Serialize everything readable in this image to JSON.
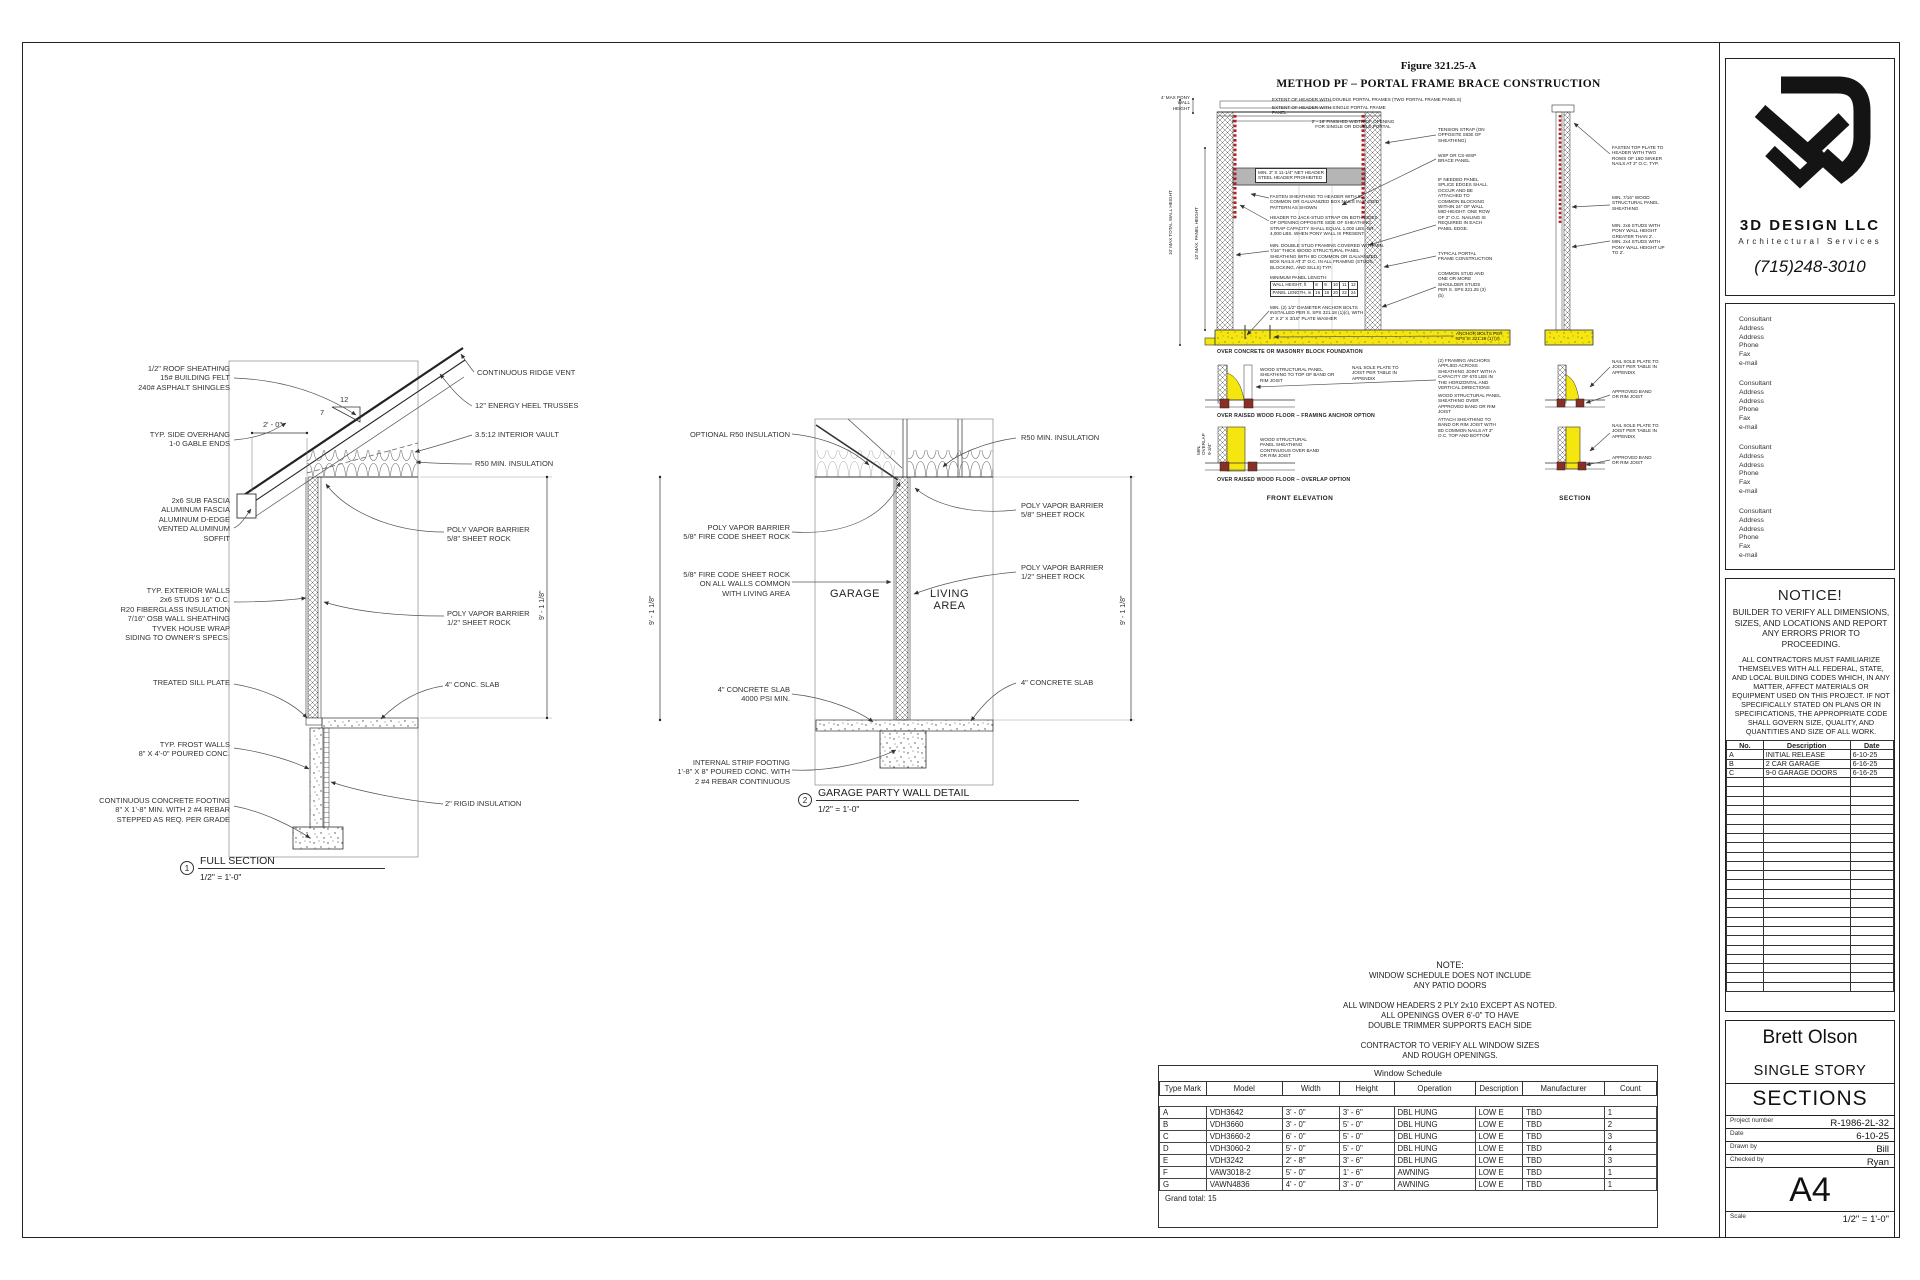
{
  "sheet": {
    "full_section": {
      "left_callouts": [
        "1/2\" ROOF SHEATHING\n15# BUILDING FELT\n240# ASPHALT SHINGLES",
        "TYP. SIDE OVERHANG\n1-0 GABLE ENDS",
        "2x6 SUB FASCIA\nALUMINUM FASCIA\nALUMINUM D-EDGE\nVENTED ALUMINUM\nSOFFIT",
        "TYP. EXTERIOR WALLS\n2x6 STUDS 16\" O.C.\nR20 FIBERGLASS INSULATION\n7/16\" OSB WALL SHEATHING\nTYVEK HOUSE WRAP\nSIDING TO OWNER'S SPECS.",
        "TREATED SILL PLATE",
        "TYP. FROST  WALLS\n8\" X 4'-0\" POURED CONC.",
        "CONTINUOUS CONCRETE FOOTING\n8\" X 1'-8\" MIN. WITH 2 #4 REBAR\nSTEPPED AS REQ. PER GRADE"
      ],
      "right_callouts": [
        "CONTINUOUS RIDGE VENT",
        "12\" ENERGY HEEL TRUSSES",
        "3.5:12 INTERIOR VAULT",
        "R50 MIN. INSULATION",
        "POLY VAPOR BARRIER\n5/8\" SHEET ROCK",
        "POLY VAPOR BARRIER\n1/2\" SHEET ROCK",
        "4\" CONC. SLAB",
        "2\" RIGID INSULATION"
      ],
      "dims": {
        "overhang": "2' - 0\"",
        "rise": "12",
        "run": "7",
        "height": "9' - 1 1/8\""
      },
      "caption": {
        "num": "1",
        "title": "FULL SECTION",
        "scale": "1/2\" = 1'-0\""
      }
    },
    "party_wall": {
      "left_callouts": [
        "OPTIONAL R50 INSULATION",
        "POLY VAPOR BARRIER\n5/8\" FIRE CODE SHEET ROCK",
        "5/8\" FIRE CODE SHEET ROCK\nON ALL WALLS COMMON\nWITH LIVING AREA",
        "4\" CONCRETE SLAB\n4000 PSI MIN.",
        "INTERNAL STRIP FOOTING\n1'-8\" X 8\" POURED CONC. WITH\n2 #4 REBAR CONTINUOUS"
      ],
      "right_callouts": [
        "R50 MIN. INSULATION",
        "POLY VAPOR BARRIER\n5/8\" SHEET ROCK",
        "POLY VAPOR BARRIER\n1/2\" SHEET ROCK",
        "4\" CONCRETE SLAB"
      ],
      "rooms": {
        "garage": "GARAGE",
        "living": "LIVING\nAREA"
      },
      "dims": {
        "height": "9' - 1 1/8\""
      },
      "caption": {
        "num": "2",
        "title": "GARAGE PARTY WALL DETAIL",
        "scale": "1/2\" = 1'-0\""
      }
    },
    "portal": {
      "figure_label": "Figure 321.25-A",
      "title": "METHOD PF – PORTAL FRAME BRACE CONSTRUCTION",
      "colors": {
        "foundation": "#f4e60e",
        "strap": "#b02020",
        "header_fill": "#b5b5b5"
      },
      "top_callouts": [
        "EXTENT OF HEADER WITH DOUBLE PORTAL FRAMES (TWO PORTAL FRAME PANELS)",
        "EXTENT OF HEADER WITH SINGLE PORTAL FRAME\nPANEL",
        "2' - 18' FINISHED WIDTH OF OPENING\nFOR SINGLE OR DOUBLE PORTAL"
      ],
      "left_dims": [
        "4' MAX PONY\nWALL HEIGHT",
        "10' MAX TOTAL WALL HEIGHT",
        "10' MAX. PANEL HEIGHT"
      ],
      "mid_callouts": [
        "MIN. 3\" X 11-1/4\" NET HEADER\nSTEEL HEADER PROHIBITED",
        "FASTEN SHEATHING TO HEADER WITH 8D\nCOMMON OR GALVANIZED BOX NAILS IN 3\" GRID\nPATTERN AS SHOWN",
        "HEADER TO JACK-STUD STRAP ON BOTH SIDES\nOF OPENING OPPOSITE SIDE OF SHEATHING.\nSTRAP CAPACITY SHALL EQUAL 1,000 LBS. OR\n4,000 LBS. WHEN PONY WALL IS PRESENT",
        "MIN. DOUBLE STUD FRAMING COVERED WITH MIN.\n7/16\" THICK WOOD STRUCTURAL PANEL\nSHEATHING WITH 8D COMMON OR GALVANIZED\nBOX NAILS AT 3\" O.C. IN ALL FRAMING (STUDS,\nBLOCKING, AND SILLS) TYP.",
        "MINIMUM PANEL LENGTH",
        "MIN. (2) 1/2\" DIAMETER ANCHOR BOLTS\nINSTALLED PER S. SPS 321.18 (1)(c), WITH\n2\" X 2\" X 3/16\" PLATE WASHER"
      ],
      "panel_table": {
        "r1": [
          "WALL HEIGHT, ft",
          "8",
          "9",
          "10",
          "11",
          "12"
        ],
        "r2": [
          "PANEL LENGTH, in",
          "16",
          "18",
          "20",
          "22",
          "24"
        ]
      },
      "right_callouts": [
        "TENSION STRAP (ON\nOPPOSITE SIDE OF\nSHEATHING)",
        "WSP OR CS-WSP\nBRACE PANEL",
        "IF NEEDED PANEL\nSPLICE EDGES SHALL\nOCCUR AND BE\nATTACHED TO\nCOMMON BLOCKING\nWITHIN 24\" OF WALL\nMID-HEIGHT. ONE ROW\nOF 3\" O.C. NAILING IS\nREQUIRED IN EACH\nPANEL EDGE.",
        "TYPICAL PORTAL\nFRAME CONSTRUCTION",
        "COMMON STUD AND\nONE OR MORE\nSHOULDER STUDS\nPER S. SPS 321.25 (3)\n(b)",
        "ANCHOR BOLTS PER\nSPS S. 321.18 (1) (c)",
        "(2) FRAMING ANCHORS\nAPPLIED ACROSS\nSHEATHING JOINT WITH A\nCAPACITY OF 670 LBS IN\nTHE HORIZONTAL AND\nVERTICAL DIRECTIONS",
        "WOOD  STRUCTURAL PANEL\nSHEATHING OVER\nAPPROVED BAND OR RIM\nJOIST",
        "ATTACH SHEATHING TO\nBAND OR RIM JOIST WITH\n8D COMMON NAILS AT 3\"\nO.C. TOP AND BOTTOM"
      ],
      "floor_callouts": [
        "WOOD STRUCTURAL PANEL\nSHEATHING TO TOP OF BAND OR\nRIM JOIST",
        "NAIL SOLE PLATE TO\nJOIST PER TABLE IN\nAPPENDIX",
        "WOOD STRUCTURAL\nPANEL SHEATHING\nCONTINUOUS OVER BAND\nOR RIM JOIST",
        "MIN.\nOVERLAP\n9-3/4\""
      ],
      "far_right_callouts": [
        "FASTEN TOP PLATE TO\nHEADER WITH TWO\nROWS OF 16D SINKER\nNAILS AT 3\" O.C. TYP.",
        "MIN. 7/16\" WOOD\nSTRUCTURAL PANEL\nSHEATHING",
        "MIN. 2x6 STUDS WITH\nPONY WALL HEIGHT\nGREATER THAN 2'.\nMIN. 2x4 STUDS WITH\nPONY WALL HEIGHT UP\nTO 2'.",
        "NAIL SOLE PLATE TO\nJOIST PER TABLE IN\nAPPENDIX",
        "APPROVED BAND\nOR RIM JOIST",
        "NAIL SOLE PLATE TO\nJOIST PER TABLE IN\nAPPENDIX",
        "APPROVED BAND\nOR RIM JOIST"
      ],
      "captions": [
        "OVER CONCRETE OR MASONRY BLOCK FOUNDATION",
        "OVER RAISED WOOD FLOOR – FRAMING ANCHOR OPTION",
        "OVER RAISED WOOD FLOOR – OVERLAP OPTION"
      ],
      "view_labels": [
        "FRONT ELEVATION",
        "SECTION"
      ]
    },
    "note": {
      "title": "NOTE:",
      "body": "WINDOW SCHEDULE DOES NOT INCLUDE\nANY PATIO DOORS\n\nALL WINDOW HEADERS 2 PLY 2x10 EXCEPT AS NOTED.\nALL OPENINGS OVER 6'-0\" TO HAVE\nDOUBLE TRIMMER SUPPORTS EACH SIDE\n\nCONTRACTOR TO VERIFY ALL WINDOW SIZES\nAND ROUGH OPENINGS."
    },
    "window_schedule": {
      "title": "Window Schedule",
      "columns": [
        "Type Mark",
        "Model",
        "Width",
        "Height",
        "Operation",
        "Description",
        "Manufacturer",
        "Count"
      ],
      "rows": [
        [
          "A",
          "VDH3642",
          "3' - 0\"",
          "3' - 6\"",
          "DBL HUNG",
          "LOW E",
          "TBD",
          "1"
        ],
        [
          "B",
          "VDH3660",
          "3' - 0\"",
          "5' - 0\"",
          "DBL HUNG",
          "LOW E",
          "TBD",
          "2"
        ],
        [
          "C",
          "VDH3660-2",
          "6' - 0\"",
          "5' - 0\"",
          "DBL HUNG",
          "LOW E",
          "TBD",
          "3"
        ],
        [
          "D",
          "VDH3060-2",
          "5' - 0\"",
          "5' - 0\"",
          "DBL HUNG",
          "LOW E",
          "TBD",
          "4"
        ],
        [
          "E",
          "VDH3242",
          "2' - 8\"",
          "3' - 6\"",
          "DBL HUNG",
          "LOW E",
          "TBD",
          "3"
        ],
        [
          "F",
          "VAW3018-2",
          "5' - 0\"",
          "1' - 6\"",
          "AWNING",
          "LOW E",
          "TBD",
          "1"
        ],
        [
          "G",
          "VAWN4836",
          "4' - 0\"",
          "3' - 0\"",
          "AWNING",
          "LOW E",
          "TBD",
          "1"
        ]
      ],
      "grand_total": "Grand total: 15"
    },
    "titleblock": {
      "company": "3D DESIGN LLC",
      "tagline": "Architectural Services",
      "phone": "(715)248-3010",
      "consultants": [
        "Consultant\nAddress\nAddress\nPhone\nFax\ne-mail",
        "Consultant\nAddress\nAddress\nPhone\nFax\ne-mail",
        "Consultant\nAddress\nAddress\nPhone\nFax\ne-mail",
        "Consultant\nAddress\nAddress\nPhone\nFax\ne-mail"
      ],
      "notice_title": "NOTICE!",
      "notice_p1": "BUILDER TO VERIFY ALL DIMENSIONS, SIZES, AND LOCATIONS AND REPORT ANY ERRORS PRIOR TO PROCEEDING.",
      "notice_p2": "ALL CONTRACTORS MUST FAMILIARIZE THEMSELVES WITH ALL FEDERAL, STATE, AND LOCAL BUILDING CODES WHICH, IN ANY MATTER, AFFECT MATERIALS OR EQUIPMENT USED ON THIS PROJECT.  IF NOT SPECIFICALLY STATED ON PLANS OR IN SPECIFICATIONS, THE APPROPRIATE CODE SHALL GOVERN SIZE, QUALITY, AND QUANTITIES AND SIZE OF ALL WORK.",
      "revisions": {
        "columns": [
          "No.",
          "Description",
          "Date"
        ],
        "rows": [
          [
            "A",
            "INITIAL RELEASE",
            "6-10-25"
          ],
          [
            "B",
            "2 CAR GARAGE",
            "6-16-25"
          ],
          [
            "C",
            "9-0 GARAGE DOORS",
            "6-16-25"
          ]
        ]
      },
      "client": "Brett Olson",
      "project": "SINGLE STORY",
      "sheet_title": "SECTIONS",
      "fields": [
        {
          "label": "Project number",
          "value": "R-1986-2L-32"
        },
        {
          "label": "Date",
          "value": "6-10-25"
        },
        {
          "label": "Drawn by",
          "value": "Bill"
        },
        {
          "label": "Checked by",
          "value": "Ryan"
        }
      ],
      "sheet_number": "A4",
      "scale_label": "Scale",
      "scale_value": "1/2\" = 1'-0\""
    }
  }
}
